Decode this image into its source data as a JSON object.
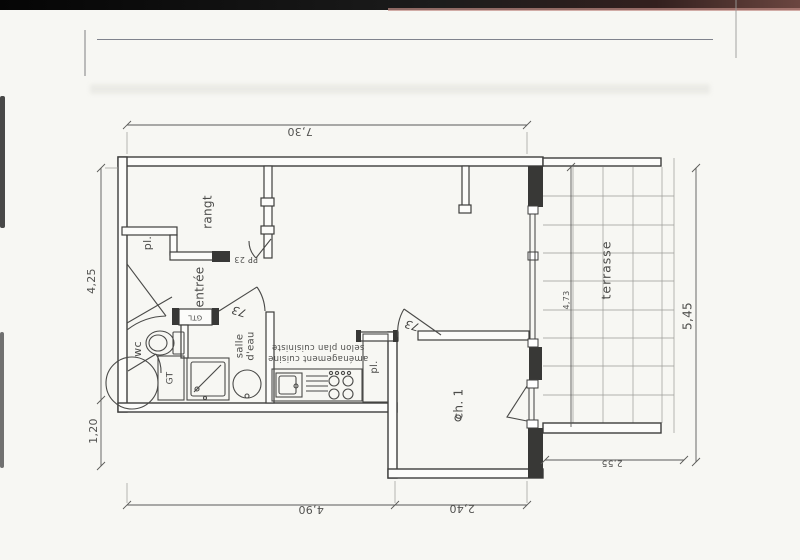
{
  "rooms": {
    "rangt": "rangt",
    "entree": "entrée",
    "wc": "wc",
    "salle_deau": [
      "salle",
      "d'eau"
    ],
    "ch1": "ch. 1",
    "terrasse": "terrasse",
    "closet_upper": "pl.",
    "closet_kitchen": "pl."
  },
  "annotations": {
    "gtl": "GTL",
    "gt": "GT",
    "entry_door": "PP 23",
    "door_width_salle_deau": "73",
    "door_width_ch1": "73",
    "kitchen_note_line1": "aménagement cuisine",
    "kitchen_note_line2": "selon plan cuisiniste"
  },
  "dimensions": {
    "top_width": "7,30",
    "left_upper": "4,25",
    "left_lower": "1,20",
    "bottom_left": "4,90",
    "bottom_right": "2,40",
    "right_height": "5,45",
    "terrace_height": "4,73",
    "terrace_width": "2,55"
  },
  "colors": {
    "line": "#3e3e3c",
    "dim_line": "#5a5a58",
    "text": "#4c4c4a",
    "paper": "#f7f7f3",
    "scan_bar": "#111111",
    "scan_tint": "#c08b85",
    "grid": "#9a9a96"
  }
}
